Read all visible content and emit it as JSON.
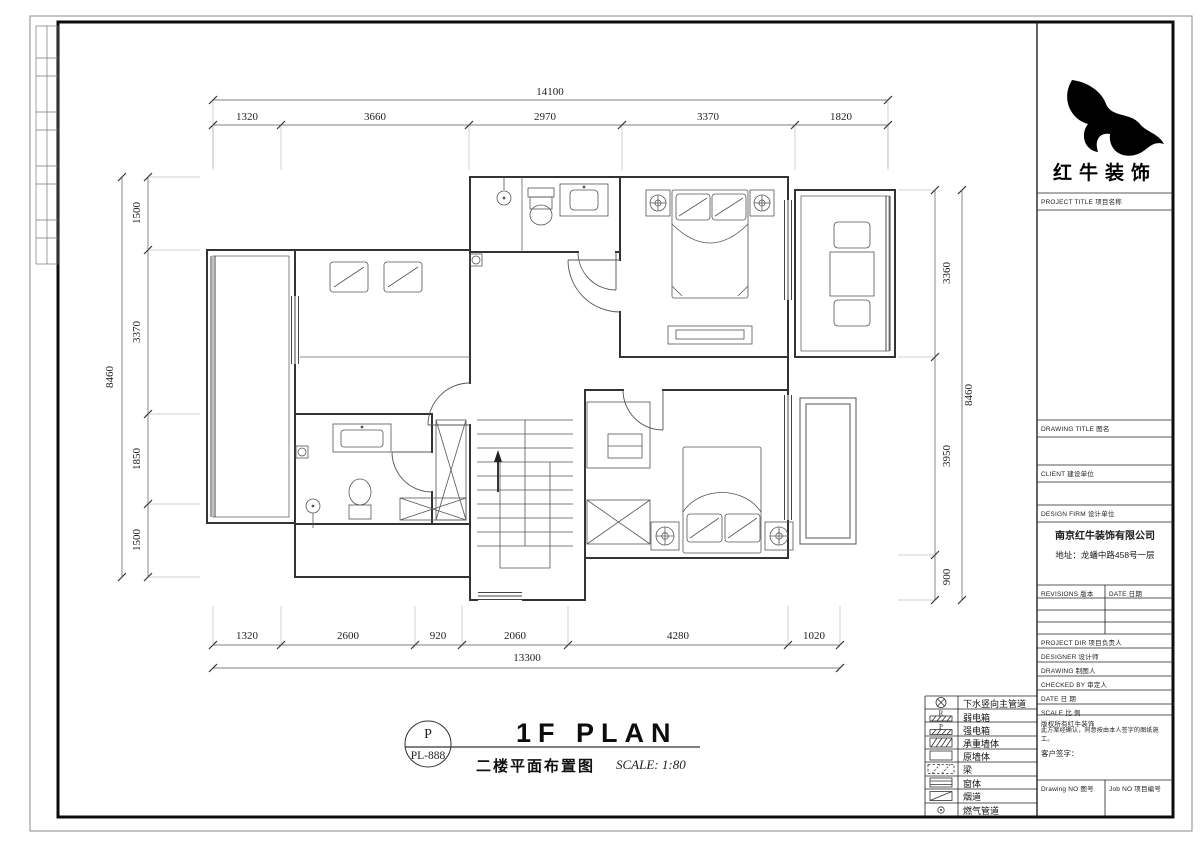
{
  "sheet": {
    "brand": "红牛装饰",
    "stamp": {
      "top": "P",
      "bottom": "PL-888"
    },
    "plan_title_en": "1F PLAN",
    "plan_title_cn": "二楼平面布置图",
    "plan_scale": "SCALE: 1:80"
  },
  "title_block": {
    "project_title": "PROJECT TITLE   项目名称",
    "drawing_title": "DRAWING TITLE   图名",
    "client": "CLIENT   建设单位",
    "design_firm": "DESIGN FIRM   设计单位",
    "firm_name": "南京红牛装饰有限公司",
    "firm_address": "地址：龙蟠中路458号一层",
    "revisions": "REVISIONS  版本",
    "revision_date": "DATE 日期",
    "project_dir": "PROJECT DIR   项目负责人",
    "designer": "DESIGNER   设计师",
    "drafter": "DRAWING   制图人",
    "checked_by": "CHECKED BY   审定人",
    "date": "DATE   日 期",
    "scale": "SCALE   比 例",
    "copyright_line1": "版权所有红牛装饰",
    "copyright_line2": "此方案经确认，同意按由本人签字的图纸施工。",
    "client_sign": "客户签字：",
    "drawing_no": "Drawing NO  图号",
    "job_no": "Job NO  项目编号"
  },
  "legend": {
    "items": [
      {
        "name": "drain-main",
        "label": "下水竖向主管道"
      },
      {
        "name": "weak-current-box",
        "letter": "R",
        "label": "弱电箱"
      },
      {
        "name": "strong-current-box",
        "letter": "P",
        "label": "强电箱"
      },
      {
        "name": "load-bearing-wall",
        "label": "承重墙体"
      },
      {
        "name": "original-wall",
        "label": "原墙体"
      },
      {
        "name": "beam",
        "label": "梁"
      },
      {
        "name": "window",
        "label": "窗体"
      },
      {
        "name": "flue",
        "label": "烟道"
      },
      {
        "name": "gas-pipe",
        "label": "燃气管道"
      }
    ]
  },
  "dimensions": {
    "top": {
      "total": "14100",
      "segments": [
        "1320",
        "3660",
        "2970",
        "3370",
        "1820"
      ]
    },
    "bottom": {
      "total": "13300",
      "segments": [
        "1320",
        "2600",
        "920",
        "2060",
        "4280",
        "1020"
      ]
    },
    "left": {
      "total": "8460",
      "segments": [
        "1500",
        "3370",
        "1850",
        "1500"
      ]
    },
    "right": {
      "total": "8460",
      "segments": [
        "3360",
        "3950",
        "900"
      ]
    }
  }
}
